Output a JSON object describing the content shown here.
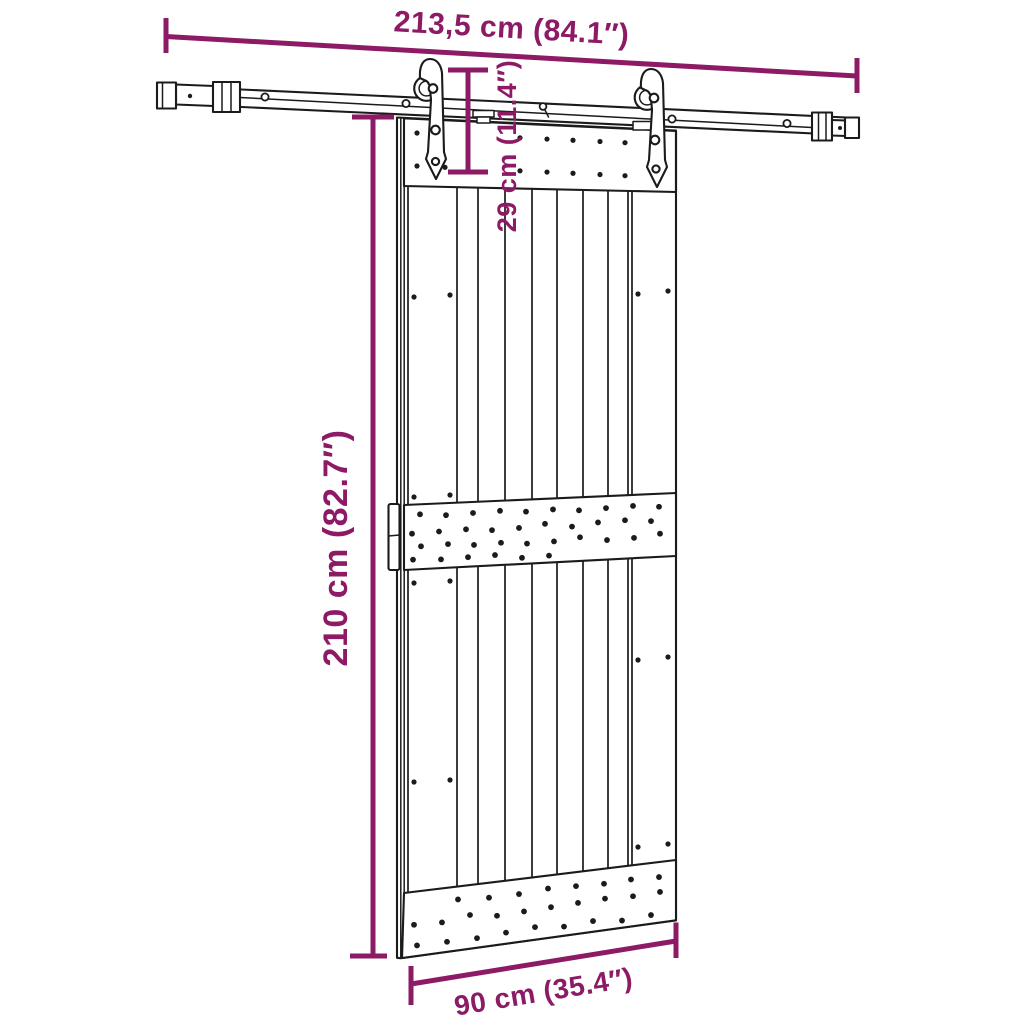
{
  "colors": {
    "dimension_accent": "#8C1A64",
    "outline": "#1B1B1B",
    "surface": "#FFFFFF"
  },
  "diagram": {
    "type": "product-dimension-diagram",
    "subject": "sliding barn door with top rail and roller hangers",
    "labels": {
      "rail_length": "213,5 cm (84.1″)",
      "hanger_height": "29 cm (11.4″)",
      "door_height": "210 cm (82.7″)",
      "door_width": "90 cm (35.4″)"
    },
    "measurements": [
      {
        "name": "rail-length",
        "cm": "213,5",
        "inches": "84.1"
      },
      {
        "name": "hanger-height",
        "cm": "29",
        "inches": "11.4"
      },
      {
        "name": "door-height",
        "cm": "210",
        "inches": "82.7"
      },
      {
        "name": "door-width",
        "cm": "90",
        "inches": "35.4"
      }
    ]
  }
}
